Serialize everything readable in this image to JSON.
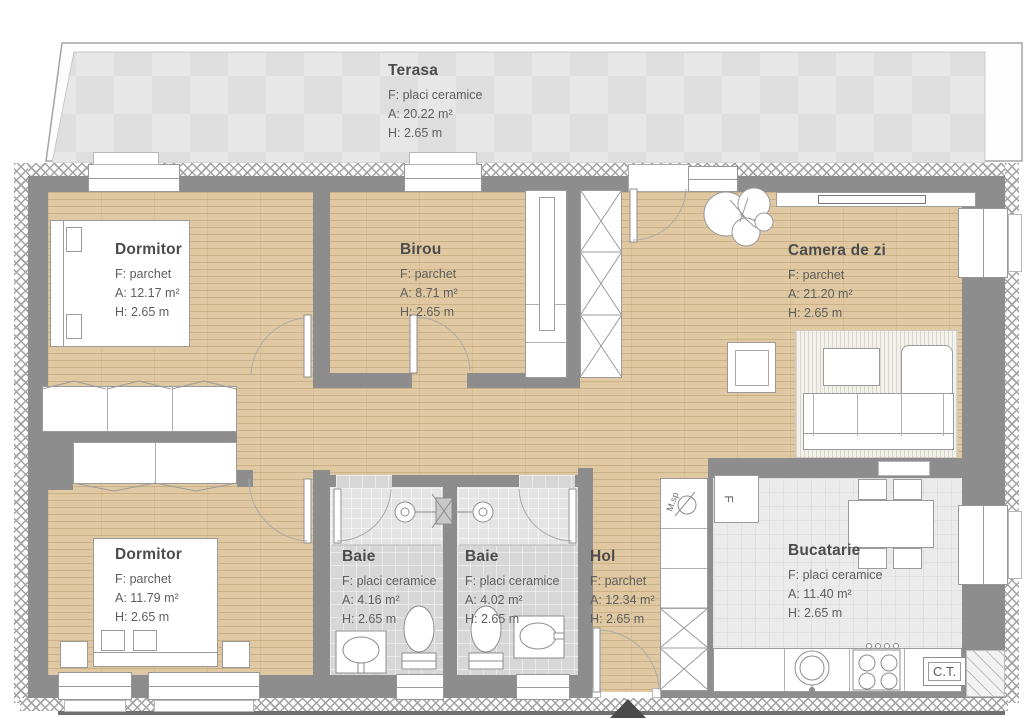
{
  "title": "Apartment floor plan",
  "colors": {
    "wall": "#8d8d8d",
    "wood_floor": "#e0c9a2",
    "ceramic_tile": "#d7d7d7",
    "kitchen_tile": "#ebebeb",
    "terrace_tile": "#e2e2e2",
    "outline": "#a5a5a5",
    "text": "#4c4c4c"
  },
  "rooms": [
    {
      "key": "terasa",
      "name": "Terasa",
      "floor": "F: placi ceramice",
      "area": "A: 20.22 m²",
      "height": "H: 2.65 m"
    },
    {
      "key": "dormitor-1",
      "name": "Dormitor",
      "floor": "F: parchet",
      "area": "A: 12.17 m²",
      "height": "H: 2.65 m"
    },
    {
      "key": "birou",
      "name": "Birou",
      "floor": "F: parchet",
      "area": "A: 8.71 m²",
      "height": "H: 2.65 m"
    },
    {
      "key": "camera-de-zi",
      "name": "Camera de zi",
      "floor": "F: parchet",
      "area": "A: 21.20 m²",
      "height": "H: 2.65 m"
    },
    {
      "key": "dormitor-2",
      "name": "Dormitor",
      "floor": "F: parchet",
      "area": "A: 11.79 m²",
      "height": "H: 2.65 m"
    },
    {
      "key": "baie-1",
      "name": "Baie",
      "floor": "F: placi ceramice",
      "area": "A: 4.16 m²",
      "height": "H: 2.65 m"
    },
    {
      "key": "baie-2",
      "name": "Baie",
      "floor": "F: placi ceramice",
      "area": "A: 4.02 m²",
      "height": "H: 2.65 m"
    },
    {
      "key": "hol",
      "name": "Hol",
      "floor": "F: parchet",
      "area": "A: 12.34 m²",
      "height": "H: 2.65 m"
    },
    {
      "key": "bucatarie",
      "name": "Bucatarie",
      "floor": "F: placi ceramice",
      "area": "A: 11.40 m²",
      "height": "H: 2.65 m"
    }
  ],
  "fixtures": {
    "boiler_label": "C.T.",
    "fridge_label": "F",
    "washer_label": "M.sp"
  }
}
